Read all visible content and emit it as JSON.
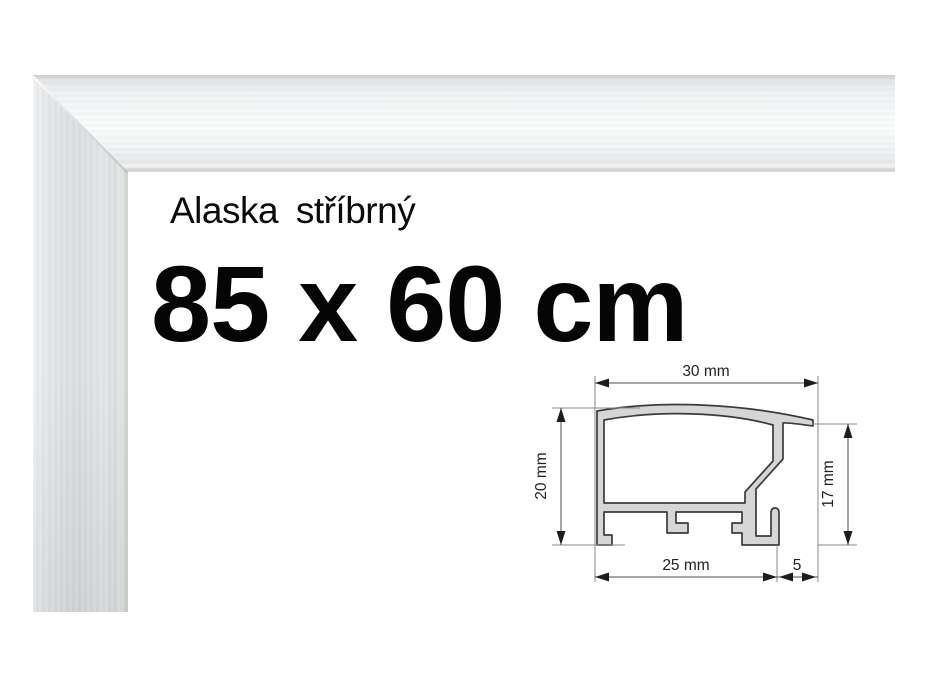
{
  "product": {
    "name": "Alaska stříbrný",
    "size_label": "85 x 60 cm"
  },
  "diagram": {
    "dimensions": {
      "top_width": "30 mm",
      "left_height": "20 mm",
      "right_height": "17 mm",
      "bottom_width": "25 mm",
      "bottom_right_width": "5"
    },
    "profile_fill": "#d6d6d6",
    "line_color": "#4d4d4d"
  },
  "colors": {
    "background": "#ffffff",
    "text": "#050505",
    "frame_silver": "#e2e4e6"
  }
}
